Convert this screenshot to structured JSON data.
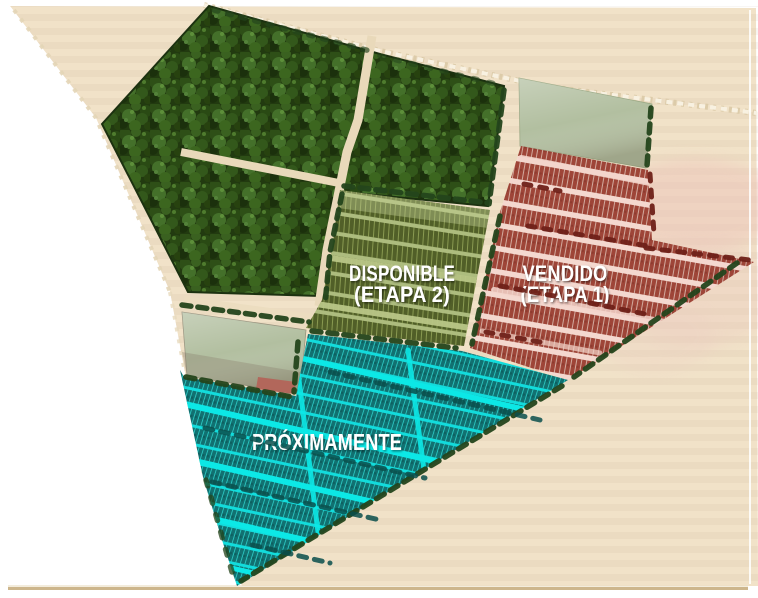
{
  "masterplan": {
    "name": "Master plan de lotes",
    "zones": [
      {
        "id": "etapa-2",
        "status_label": "DISPONIBLE",
        "stage_label": "(ETAPA 2)",
        "status": "available",
        "lot_color": "#515f28",
        "road_color": "#adbc7e",
        "divider_color": "#8fa155"
      },
      {
        "id": "etapa-1",
        "status_label": "VENDIDO",
        "stage_label": "(ETAPA 1)",
        "status": "sold",
        "lot_color": "#9e4538",
        "road_color": "#f4d8cf",
        "divider_color": "#d8b5a9"
      },
      {
        "id": "etapa-3",
        "status_label": "PRÓXIMAMENTE",
        "stage_label": "",
        "status": "coming_soon",
        "lot_color": "#117171",
        "road_color": "#12dcdc",
        "divider_color": "#2fd0ca"
      }
    ],
    "environment": {
      "page_background": "#ffffff",
      "land_color": "#f1e2c8",
      "land_stripe_color": "#cdb68c",
      "forest_color": "#223a10",
      "forest_road_color": "#e9d9ba",
      "reserve_block_color": "#b2bfa0",
      "reserve_patch_color": "#b2675b",
      "hedge_color": "#24451c",
      "red_hedge_color": "#6f2119",
      "teal_hedge_color": "#0a4f4c",
      "boundary_dot_color": "#f8f1e1",
      "haze_color": "#eec7bc"
    }
  }
}
